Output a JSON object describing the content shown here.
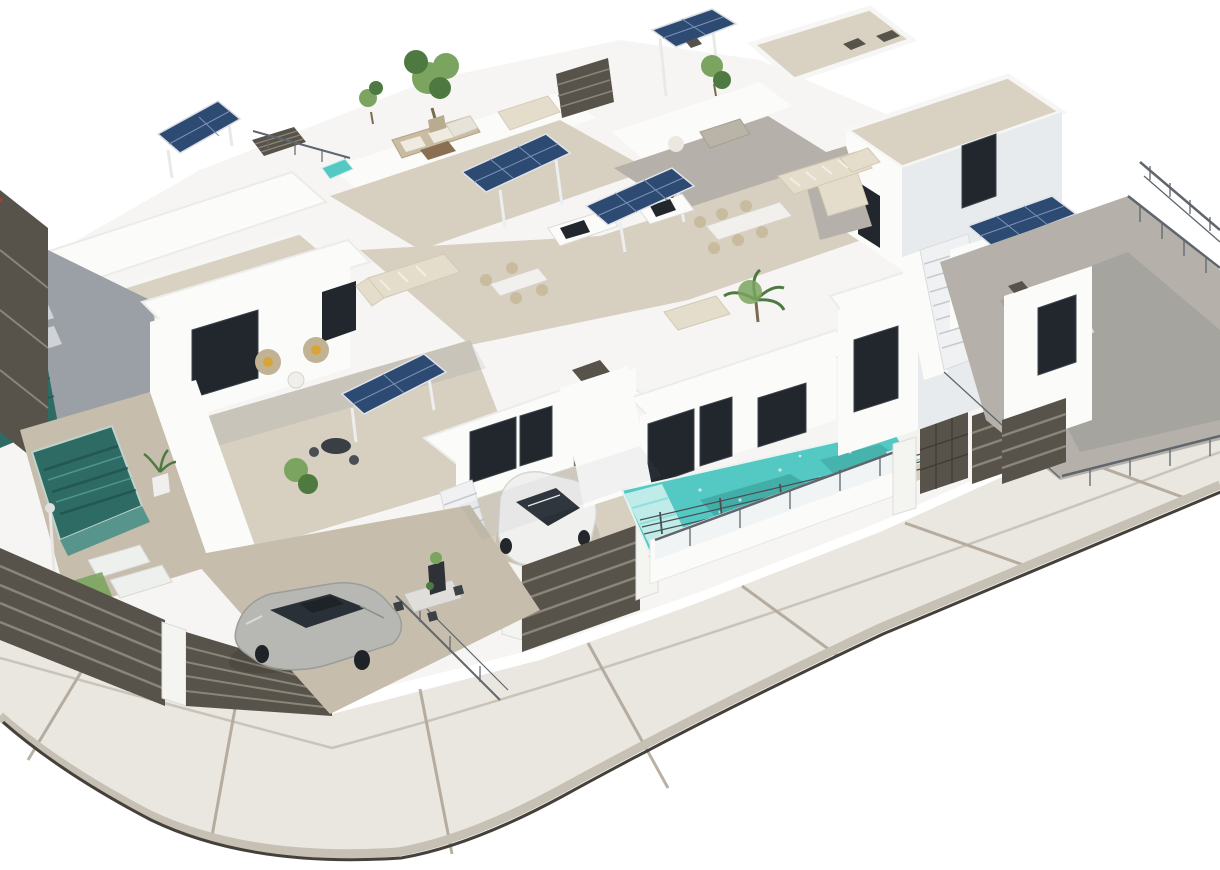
{
  "scene": {
    "type": "3d-architectural-render",
    "subject": "Aerial isometric 3D render of a white modern villa complex with roof terraces, solar panels, private pools, slatted fences, two parked cars and a curved sidewalk street corner on a white background",
    "objects": [
      {
        "name": "white-villa-block",
        "count": 6
      },
      {
        "name": "solar-panel-array",
        "count": 6
      },
      {
        "name": "private-pool",
        "count": 4
      },
      {
        "name": "parked-car",
        "count": 2,
        "colors": [
          "silver",
          "white"
        ]
      },
      {
        "name": "outdoor-staircase",
        "count": 2
      },
      {
        "name": "roof-terrace",
        "count": 5
      },
      {
        "name": "outdoor-kitchen-pergola",
        "count": 2
      },
      {
        "name": "slatted-fence-section",
        "count": 7
      },
      {
        "name": "glass-railing",
        "count": 5
      },
      {
        "name": "sun-lounger",
        "count": 6
      },
      {
        "name": "outdoor-sofa-set",
        "count": 6
      },
      {
        "name": "dining-set",
        "count": 4
      },
      {
        "name": "tree-or-plant",
        "count": 10
      },
      {
        "name": "street-sidewalk-corner",
        "count": 1
      }
    ]
  },
  "palette": {
    "white": "#ffffff",
    "wall": "#fbfbf9",
    "wall-shade": "#e8ebee",
    "wall-dark": "#b9c1c8",
    "window": "#21272d",
    "roof-gravel": "#d9d2c3",
    "roof-gravel-dark": "#cfc6b5",
    "tile": "#d7cfc0",
    "tile-shade": "#c6bdac",
    "grey-tile": "#b5b1aa",
    "solar": "#2d4a72",
    "solar-line": "#7b93b5",
    "pool-dark": "#2e6b64",
    "pool-bright": "#54c8c2",
    "pave": "#eae6e0",
    "pave-joint": "#a89e90",
    "curb": "#c7c0b4",
    "curb-edge": "#45413a",
    "fence": "#57534a",
    "fence-line": "#8b8478",
    "pillar": "#f4f4f1",
    "railing": "#5f666d",
    "green": "#7aa45f",
    "green-dark": "#4e7a41",
    "sofa": "#e5ddcc",
    "car-white": "#f0f0ee",
    "car-silver": "#b7b8b4",
    "glass": "#2a3037",
    "step-line": "#c6cacd"
  }
}
